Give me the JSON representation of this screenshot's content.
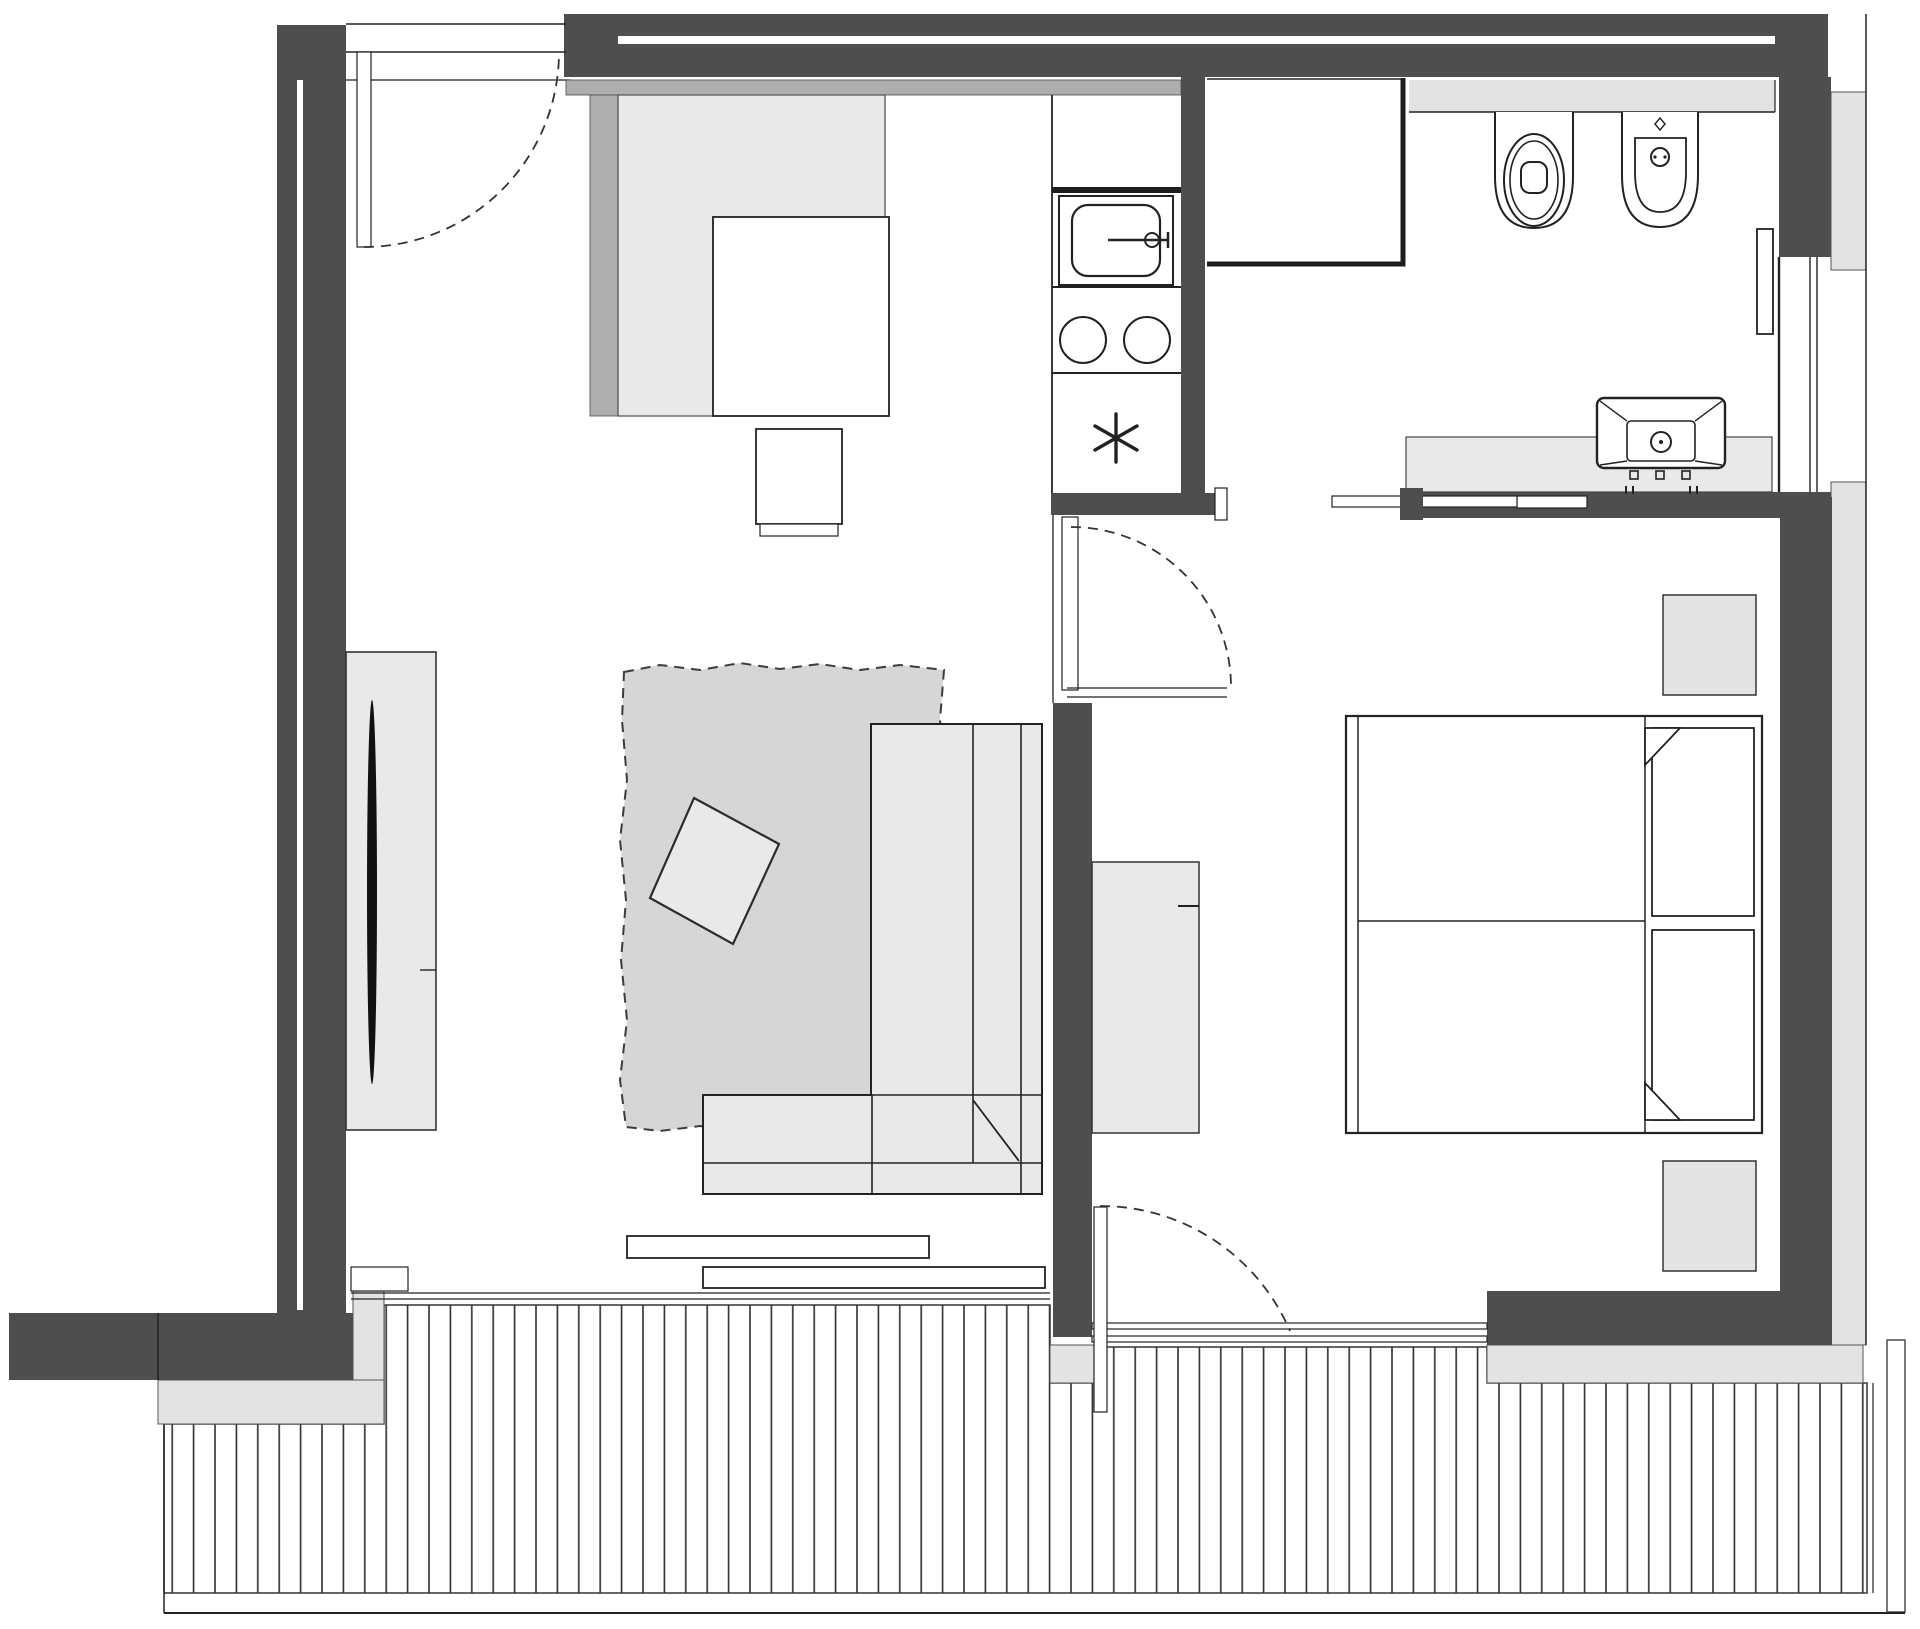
{
  "meta": {
    "domain": "Diagram",
    "diagram_type": "architectural-floor-plan",
    "description": "Monochrome top-down floor plan of a one-bedroom apartment with open living/kitchen area, hallway, bathroom, bedroom and a wooden deck terrace along the bottom edge",
    "visible_text": []
  },
  "colors": {
    "wall": "#4e4e4e",
    "line": "#222222",
    "thin": "#333333",
    "furn": "#e9e9e9",
    "furn2": "#e4e4e4",
    "rug": "#d6d6d6",
    "band": "#e3e3e3",
    "mid": "#aeaeae",
    "bg": "#ffffff"
  },
  "rooms": [
    {
      "name": "living-room",
      "fixtures": [
        "entry-door",
        "tv-cabinet",
        "tv",
        "rug",
        "floor-cushion",
        "corner-sofa",
        "sliding-glass-door-sills"
      ]
    },
    {
      "name": "kitchen",
      "fixtures": [
        "l-shaped-counter",
        "dining-table",
        "chair",
        "kitchen-sink",
        "faucet",
        "two-burner-hob",
        "freezer-star-symbol"
      ]
    },
    {
      "name": "hallway",
      "fixtures": [
        "hinged-door",
        "wardrobe",
        "terrace-door"
      ]
    },
    {
      "name": "bathroom",
      "fixtures": [
        "shower",
        "wall-shelf",
        "toilet",
        "bidet",
        "radiator",
        "window",
        "vanity-counter",
        "washbasin",
        "pocket-sliding-door"
      ]
    },
    {
      "name": "bedroom",
      "fixtures": [
        "double-bed",
        "pillow-left",
        "pillow-right",
        "nightstand-top",
        "nightstand-bottom"
      ]
    },
    {
      "name": "terrace",
      "fixtures": [
        "wood-decking",
        "edge-band",
        "perimeter-line"
      ]
    }
  ]
}
